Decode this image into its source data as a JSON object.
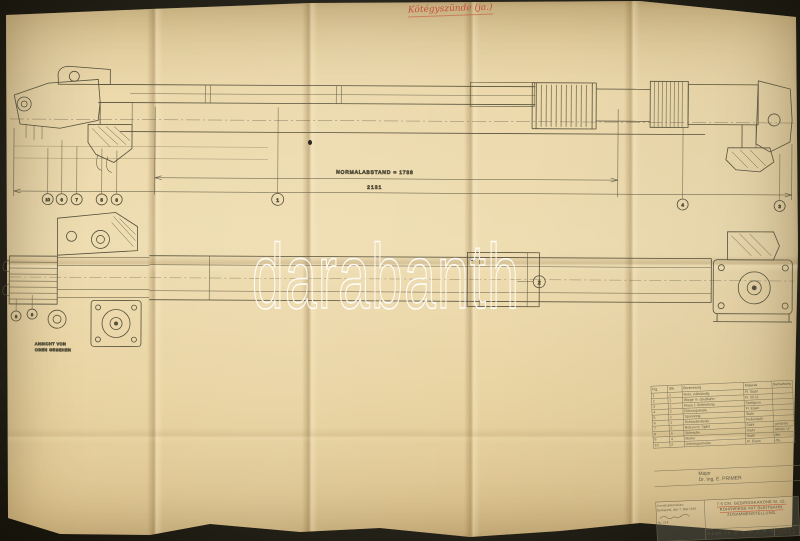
{
  "photo": {
    "watermark_text": "darabanth"
  },
  "handwriting": {
    "note": "Kötégyszünde (ja.)"
  },
  "drawing": {
    "dim_label_main": "NORMALABSTAND = 1788",
    "dim_label_secondary": "2131",
    "section_label_line1": "ANSICHT VON",
    "section_label_line2": "OBEN GESEHEN",
    "balloons": [
      "10",
      "6",
      "7",
      "5",
      "8",
      "1",
      "2",
      "4",
      "3",
      "8",
      "9"
    ]
  },
  "names_block": {
    "line1": "Major",
    "line2": "Dr. Ing. E. PRIMER"
  },
  "stamp_block": {
    "line1": "Konstruktionsbüro",
    "line2": "Budapest, den 7. Mai 1915.",
    "line3": "Nr. 214."
  },
  "title_block": {
    "line1": "7.5 CM. GEBIRGSKANONE M. 15.",
    "line2": "ROHRWIEGE MIT GLEITBAHN.",
    "line3": "ZUSAMMENSTELLUNG.",
    "scale_note": "M. d. Zchn.",
    "scale_ruler": "10 0 1 2 3 4 5",
    "drawing_number": "5011"
  },
  "parts_table": {
    "headers": [
      "Fig.",
      "Stk.",
      "Benennung",
      "Material",
      "Bemerkung"
    ],
    "rows": [
      {
        "fig": "1",
        "stk": "1",
        "name": "Rohr, vollständig",
        "mat": "Fl. Stahl",
        "note": ""
      },
      {
        "fig": "2",
        "stk": "1",
        "name": "Wiege m. Gleitbahn",
        "mat": "Fl. 50.11",
        "note": ""
      },
      {
        "fig": "3",
        "stk": "1",
        "name": "Klaue f. Verbindung",
        "mat": "Stahlguss",
        "note": ""
      },
      {
        "fig": "4",
        "stk": "2",
        "name": "Führungsleiste",
        "mat": "Fl. Eisen",
        "note": ""
      },
      {
        "fig": "5",
        "stk": "1",
        "name": "Spannring",
        "mat": "Stahl",
        "note": ""
      },
      {
        "fig": "6",
        "stk": "1",
        "name": "Schraubenfeder",
        "mat": "Federstahl",
        "note": ""
      },
      {
        "fig": "7",
        "stk": "2",
        "name": "Bolzen m. Splint",
        "mat": "Stahl",
        "note": "gehärtet"
      },
      {
        "fig": "8",
        "stk": "4",
        "name": "Schraube",
        "mat": "Stahl",
        "note": "Whitw. ½\""
      },
      {
        "fig": "9",
        "stk": "4",
        "name": "Mutter",
        "mat": "Stahl",
        "note": "dto."
      },
      {
        "fig": "10",
        "stk": "2",
        "name": "Unterlagscheibe",
        "mat": "Fl. Eisen",
        "note": "dto."
      }
    ]
  }
}
